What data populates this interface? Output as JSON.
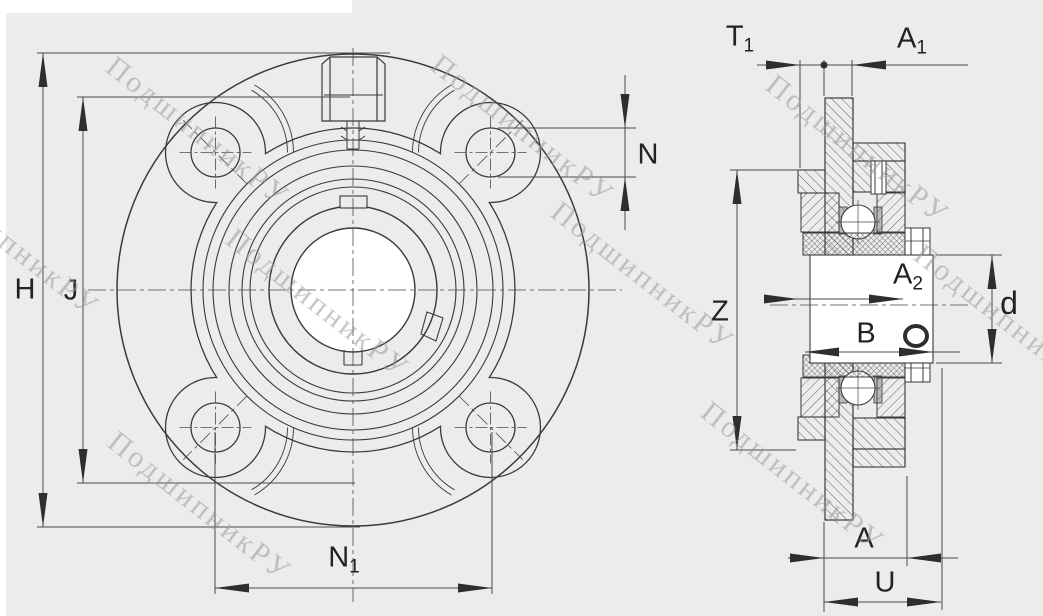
{
  "watermark": {
    "text": "ПодшипникРУ"
  },
  "front_view": {
    "dims": {
      "H": "H",
      "J": "J",
      "N": "N",
      "N1": {
        "base": "N",
        "sub": "1"
      }
    }
  },
  "side_view": {
    "dims": {
      "T1": {
        "base": "T",
        "sub": "1"
      },
      "A1": {
        "base": "A",
        "sub": "1"
      },
      "A2": {
        "base": "A",
        "sub": "2"
      },
      "Z": "Z",
      "B": "B",
      "d": "d",
      "A": "A",
      "U": "U"
    }
  }
}
